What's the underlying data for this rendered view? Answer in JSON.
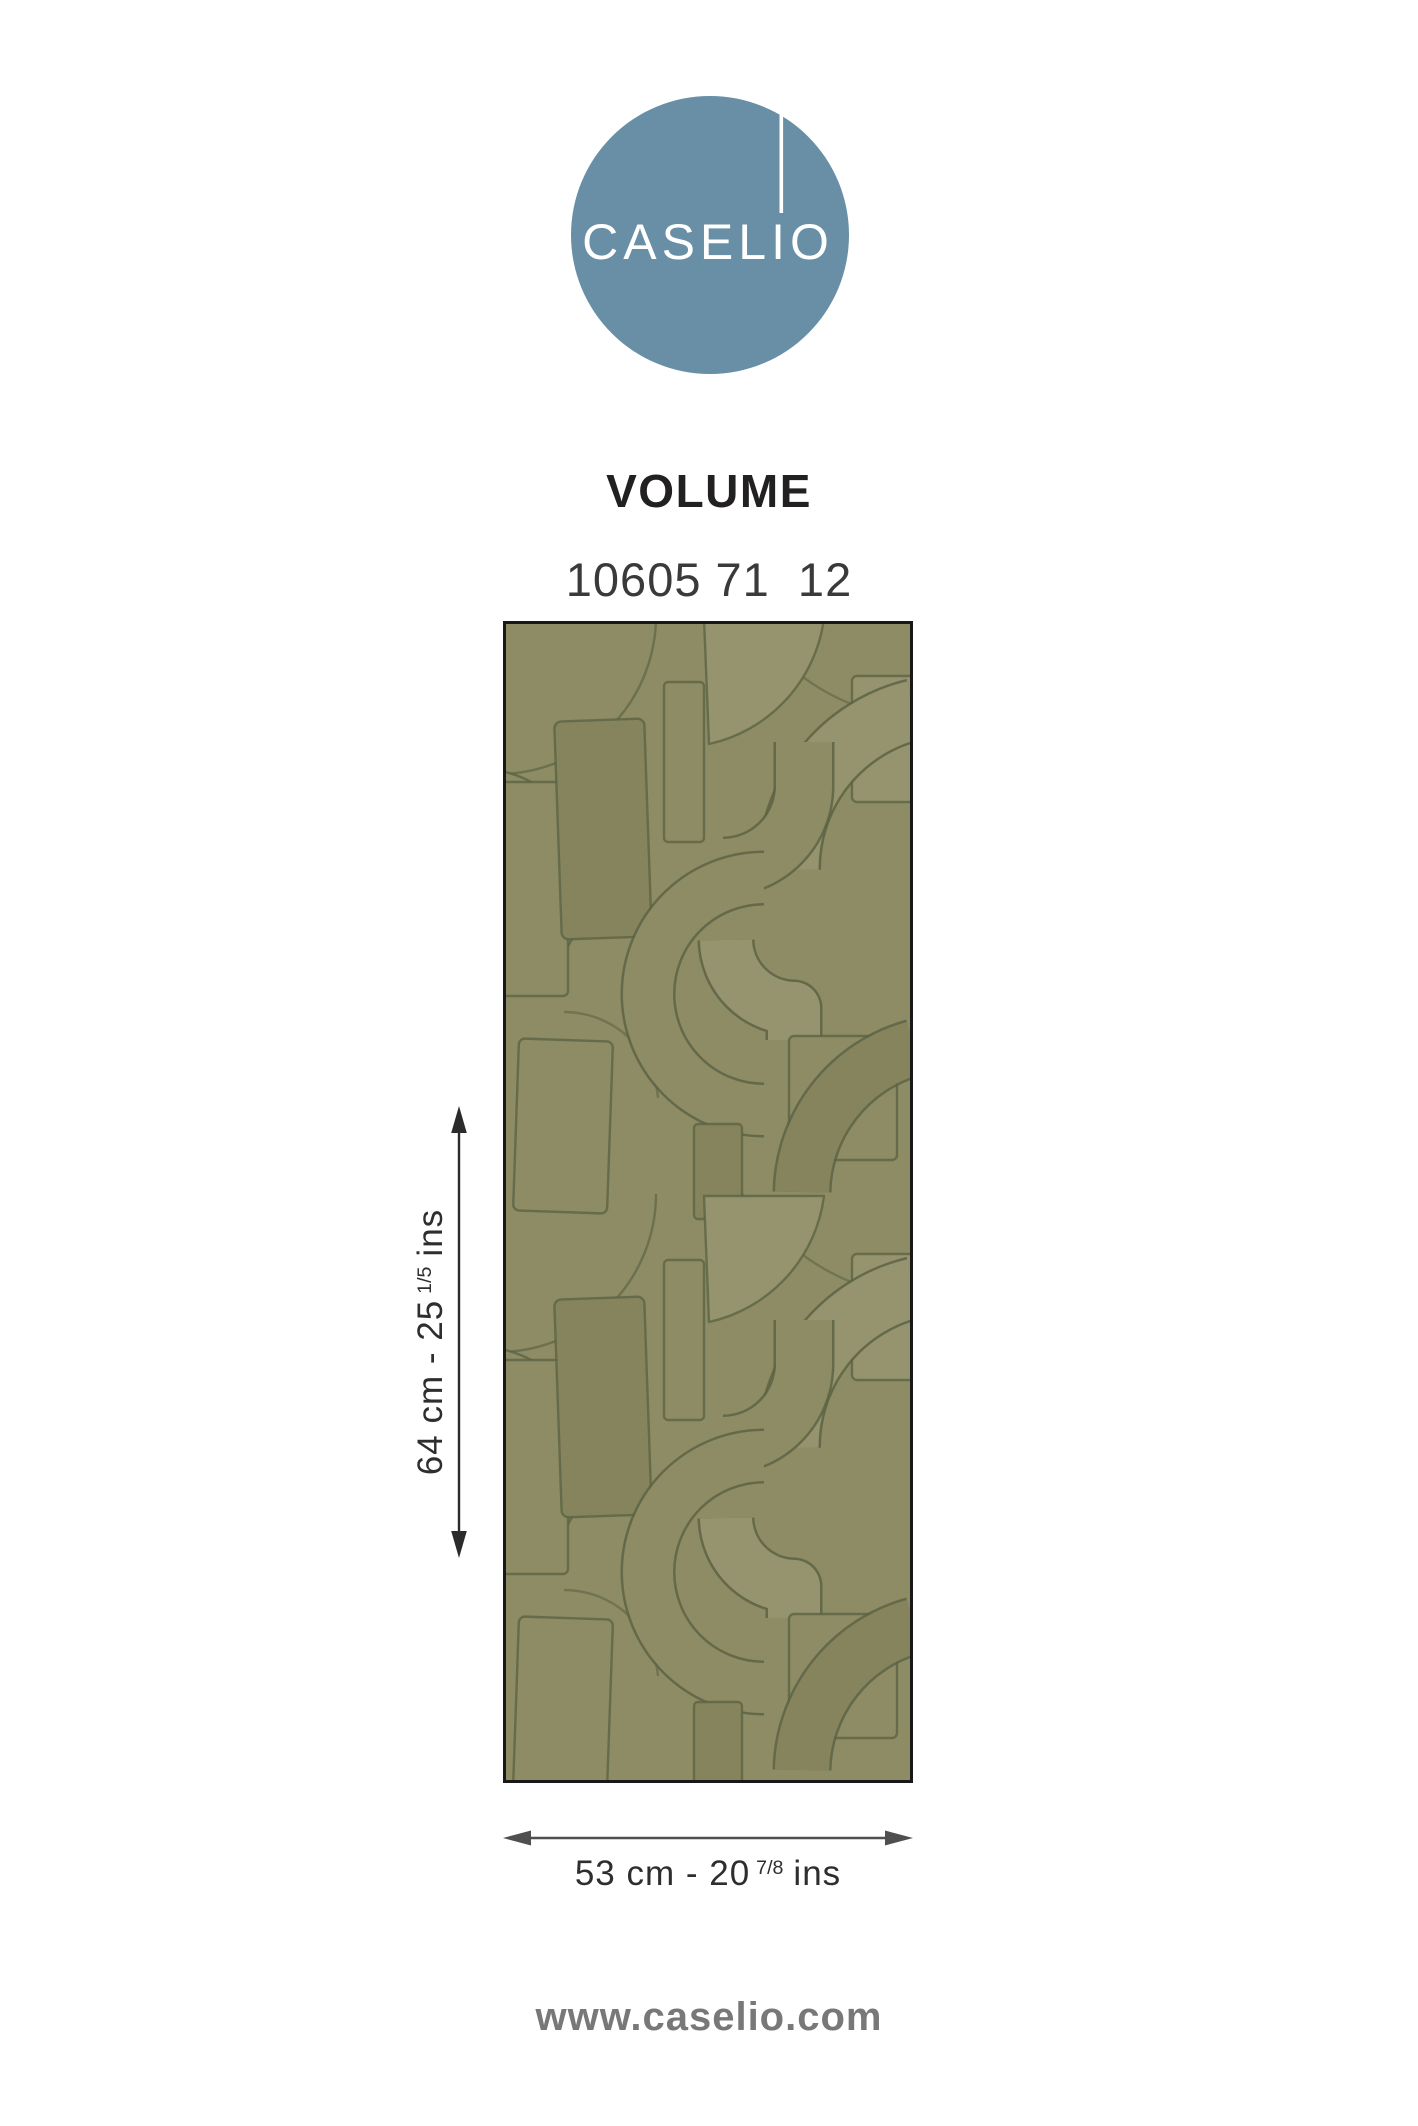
{
  "page": {
    "background": "#ffffff"
  },
  "logo": {
    "brand": "CASELIO",
    "circle_color": "#688FA5",
    "text_color": "#FFFFFF"
  },
  "product": {
    "collection": "VOLUME",
    "reference": "10605 71  12"
  },
  "swatch": {
    "base_color": "#8D8C65",
    "light_shape_color": "#95946E",
    "dark_shape_color": "#85845D",
    "outline_color": "#5D6444",
    "border_color": "#181818"
  },
  "dimensions": {
    "height": {
      "prefix": "64 cm - 25",
      "fraction": "1/5",
      "suffix": "ins"
    },
    "width": {
      "prefix": "53 cm - 20",
      "fraction": "7/8",
      "suffix": "ins"
    }
  },
  "arrows": {
    "vertical_color": "#2b2b2b",
    "horizontal_color": "#4f4f4f"
  },
  "footer": {
    "website": "www.caselio.com"
  }
}
